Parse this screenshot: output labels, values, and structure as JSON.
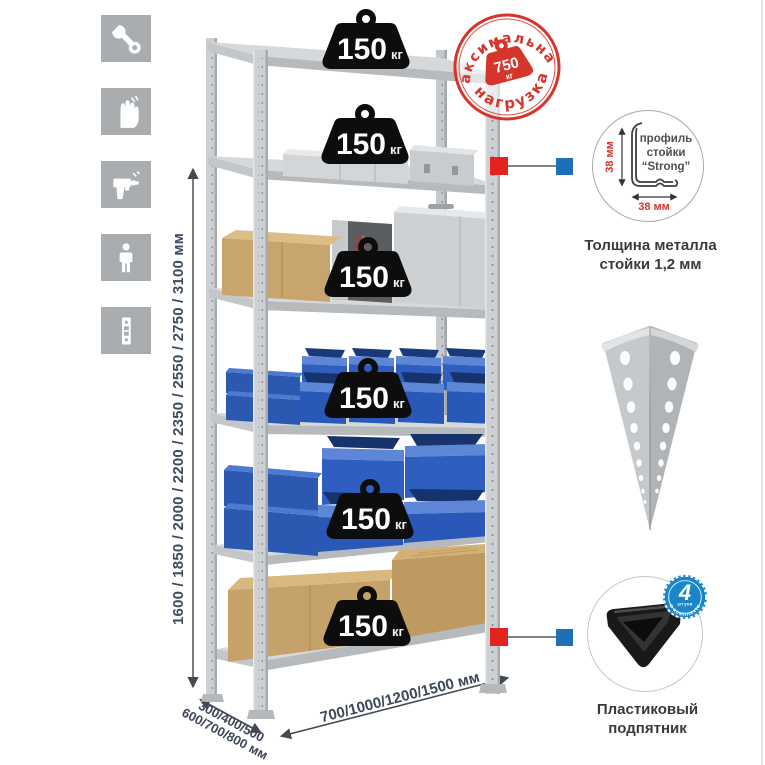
{
  "assembly_icons": [
    "wrench-icon",
    "work-gloves-icon",
    "drill-icon",
    "person-icon",
    "rack-post-icon"
  ],
  "dimensions": {
    "height": "1600 / 1850 / 2000 / 2200 / 2350 / 2550 / 2750 / 3100 мм",
    "depth_line1": "300/400/500",
    "depth_line2": "600/700/800 мм",
    "width": "700/1000/1200/1500 мм"
  },
  "max_load_stamp": {
    "arc_top": "максимальная",
    "arc_bottom": "нагрузка",
    "value": "750",
    "unit": "кг"
  },
  "shelf_load": {
    "unit": "кг",
    "weights": [
      "150",
      "150",
      "150",
      "150",
      "150",
      "150"
    ]
  },
  "profile_callout": {
    "vertical_size": "38 мм",
    "horizontal_size": "38 мм",
    "label_line1": "профиль",
    "label_line2": "стойки",
    "label_line3": "“Strong”",
    "caption_line1": "Толщина металла",
    "caption_line2": "стойки 1,2 мм"
  },
  "foot_callout": {
    "badge_count": "4",
    "badge_small": "штуки",
    "badge_arc": "в комплекте",
    "caption_line1": "Пластиковый",
    "caption_line2": "подпятник"
  },
  "colors": {
    "stamp_red": "#d6352c",
    "marker_red": "#e3231f",
    "marker_blue": "#1d6fb8",
    "bin_blue": "#2e5fc0",
    "metal_gray": "#cdd0d2",
    "icon_tile_gray": "#a9adb0",
    "dimension_text": "#3d4a5f"
  }
}
